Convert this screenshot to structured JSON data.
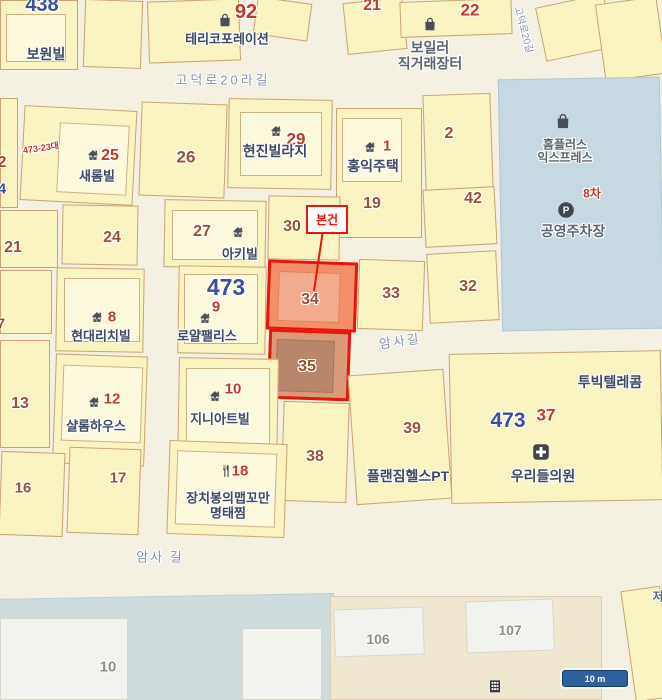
{
  "colors": {
    "red": "#c13a28",
    "brown": "#9a5134",
    "blue": "#3c4f9e",
    "gray": "#8e8e86",
    "label": "#3e4a61",
    "poi": "#5b656e",
    "road": "#8494aa",
    "redtext": "#b0402c",
    "highlight_border": "#e9150c",
    "highlight_fill": "#f2906b"
  },
  "map": {
    "callout": {
      "label": "본건"
    },
    "scale_bar": {
      "label": "10 m"
    },
    "numbers": [
      {
        "t": "438",
        "x": 42,
        "y": 5,
        "s": 20,
        "c": "blue"
      },
      {
        "t": "92",
        "x": 246,
        "y": 12,
        "s": 20,
        "c": "red"
      },
      {
        "t": "21",
        "x": 372,
        "y": 6,
        "s": 16,
        "c": "red"
      },
      {
        "t": "22",
        "x": 470,
        "y": 10,
        "s": 17,
        "c": "red"
      },
      {
        "t": "473-23대",
        "x": 41,
        "y": 148,
        "s": 9,
        "c": "red",
        "r": -8
      },
      {
        "t": "25",
        "x": 110,
        "y": 156,
        "s": 16,
        "c": "red"
      },
      {
        "t": "26",
        "x": 186,
        "y": 157,
        "s": 17,
        "c": "brown"
      },
      {
        "t": "29",
        "x": 296,
        "y": 139,
        "s": 17,
        "c": "red"
      },
      {
        "t": "1",
        "x": 387,
        "y": 147,
        "s": 15,
        "c": "red"
      },
      {
        "t": "2",
        "x": 449,
        "y": 134,
        "s": 16,
        "c": "brown"
      },
      {
        "t": "2",
        "x": 2,
        "y": 163,
        "s": 16,
        "c": "red"
      },
      {
        "t": "4",
        "x": 2,
        "y": 190,
        "s": 15,
        "c": "blue"
      },
      {
        "t": "19",
        "x": 372,
        "y": 204,
        "s": 16,
        "c": "brown"
      },
      {
        "t": "42",
        "x": 473,
        "y": 199,
        "s": 16,
        "c": "brown"
      },
      {
        "t": "21",
        "x": 13,
        "y": 248,
        "s": 16,
        "c": "brown"
      },
      {
        "t": "24",
        "x": 112,
        "y": 238,
        "s": 16,
        "c": "brown"
      },
      {
        "t": "27",
        "x": 202,
        "y": 232,
        "s": 16,
        "c": "brown"
      },
      {
        "t": "30",
        "x": 292,
        "y": 227,
        "s": 16,
        "c": "brown"
      },
      {
        "t": "473",
        "x": 226,
        "y": 288,
        "s": 23,
        "c": "blue"
      },
      {
        "t": "9",
        "x": 216,
        "y": 308,
        "s": 15,
        "c": "red"
      },
      {
        "t": "8",
        "x": 112,
        "y": 318,
        "s": 15,
        "c": "red"
      },
      {
        "t": "7",
        "x": 1,
        "y": 325,
        "s": 15,
        "c": "brown"
      },
      {
        "t": "34",
        "x": 310,
        "y": 300,
        "s": 16,
        "c": "brown"
      },
      {
        "t": "33",
        "x": 391,
        "y": 294,
        "s": 16,
        "c": "brown"
      },
      {
        "t": "32",
        "x": 468,
        "y": 287,
        "s": 16,
        "c": "brown"
      },
      {
        "t": "35",
        "x": 307,
        "y": 367,
        "s": 16,
        "c": "brown"
      },
      {
        "t": "13",
        "x": 20,
        "y": 404,
        "s": 16,
        "c": "brown"
      },
      {
        "t": "12",
        "x": 112,
        "y": 400,
        "s": 15,
        "c": "red"
      },
      {
        "t": "10",
        "x": 233,
        "y": 390,
        "s": 15,
        "c": "red"
      },
      {
        "t": "39",
        "x": 412,
        "y": 429,
        "s": 16,
        "c": "brown"
      },
      {
        "t": "473",
        "x": 508,
        "y": 421,
        "s": 21,
        "c": "blue"
      },
      {
        "t": "37",
        "x": 546,
        "y": 415,
        "s": 17,
        "c": "red"
      },
      {
        "t": "38",
        "x": 315,
        "y": 457,
        "s": 16,
        "c": "brown"
      },
      {
        "t": "18",
        "x": 240,
        "y": 472,
        "s": 15,
        "c": "red"
      },
      {
        "t": "16",
        "x": 23,
        "y": 489,
        "s": 15,
        "c": "brown"
      },
      {
        "t": "17",
        "x": 118,
        "y": 479,
        "s": 15,
        "c": "brown"
      },
      {
        "t": "10",
        "x": 108,
        "y": 668,
        "s": 15,
        "c": "gray"
      },
      {
        "t": "106",
        "x": 378,
        "y": 640,
        "s": 14,
        "c": "gray"
      },
      {
        "t": "107",
        "x": 510,
        "y": 631,
        "s": 14,
        "c": "gray"
      }
    ],
    "place_labels": [
      {
        "t": "보원빌",
        "x": 46,
        "y": 55,
        "s": 14
      },
      {
        "t": "테리코포레이션",
        "x": 227,
        "y": 40,
        "s": 13
      },
      {
        "lines": [
          "보일러",
          "직거래장터"
        ],
        "x": 430,
        "y": 56,
        "s": 14,
        "c": "poi"
      },
      {
        "t": "새롬빌",
        "x": 97,
        "y": 177,
        "s": 13
      },
      {
        "t": "현진빌라지",
        "x": 275,
        "y": 152,
        "s": 14
      },
      {
        "t": "홍익주택",
        "x": 373,
        "y": 167,
        "s": 14
      },
      {
        "lines": [
          "홈플러스",
          "익스프레스"
        ],
        "x": 565,
        "y": 152,
        "s": 12,
        "c": "poi"
      },
      {
        "t": "8차",
        "x": 592,
        "y": 194,
        "s": 12,
        "c": "redtext"
      },
      {
        "t": "공영주차장",
        "x": 573,
        "y": 232,
        "s": 14,
        "c": "poi"
      },
      {
        "t": "아키빌",
        "x": 240,
        "y": 255,
        "s": 13
      },
      {
        "t": "현대리치빌",
        "x": 101,
        "y": 337,
        "s": 13
      },
      {
        "t": "로얄팰리스",
        "x": 207,
        "y": 337,
        "s": 13
      },
      {
        "t": "샬롬하우스",
        "x": 96,
        "y": 427,
        "s": 13
      },
      {
        "t": "지니아트빌",
        "x": 220,
        "y": 420,
        "s": 13
      },
      {
        "t": "투빅텔레콤",
        "x": 610,
        "y": 383,
        "s": 14
      },
      {
        "t": "플랜짐헬스PT",
        "x": 408,
        "y": 477,
        "s": 14
      },
      {
        "t": "우리들의원",
        "x": 543,
        "y": 477,
        "s": 14
      },
      {
        "lines": [
          "장치봉의맵꼬만",
          "명태찜"
        ],
        "x": 228,
        "y": 506,
        "s": 13
      },
      {
        "t": "저",
        "x": 658,
        "y": 597,
        "s": 12,
        "c": "poi"
      }
    ],
    "road_labels": [
      {
        "t": "고덕로20라길",
        "x": 223,
        "y": 81,
        "s": 13,
        "ls": 3
      },
      {
        "t": "고덕로20길",
        "x": 523,
        "y": 30,
        "s": 10,
        "r": 75
      },
      {
        "t": "암사길",
        "x": 400,
        "y": 342,
        "s": 13,
        "r": -8,
        "ls": 2
      },
      {
        "t": "암사 길",
        "x": 160,
        "y": 558,
        "s": 13,
        "ls": 2
      }
    ],
    "icons": [
      {
        "k": "bag",
        "x": 225,
        "y": 20,
        "s": 15
      },
      {
        "k": "bag",
        "x": 430,
        "y": 24,
        "s": 15
      },
      {
        "k": "bag",
        "x": 563,
        "y": 121,
        "s": 17
      },
      {
        "k": "home",
        "x": 93,
        "y": 155,
        "s": 13
      },
      {
        "k": "home",
        "x": 276,
        "y": 131,
        "s": 13
      },
      {
        "k": "home",
        "x": 370,
        "y": 147,
        "s": 13
      },
      {
        "k": "home",
        "x": 238,
        "y": 232,
        "s": 13
      },
      {
        "k": "home",
        "x": 97,
        "y": 317,
        "s": 13
      },
      {
        "k": "home",
        "x": 205,
        "y": 318,
        "s": 13
      },
      {
        "k": "home",
        "x": 94,
        "y": 402,
        "s": 13
      },
      {
        "k": "home",
        "x": 215,
        "y": 396,
        "s": 13
      },
      {
        "k": "fork",
        "x": 226,
        "y": 471,
        "s": 14
      },
      {
        "k": "parking",
        "x": 566,
        "y": 210,
        "s": 17
      },
      {
        "k": "cross",
        "x": 541,
        "y": 452,
        "s": 17
      },
      {
        "k": "grid",
        "x": 495,
        "y": 686,
        "s": 15
      }
    ]
  }
}
